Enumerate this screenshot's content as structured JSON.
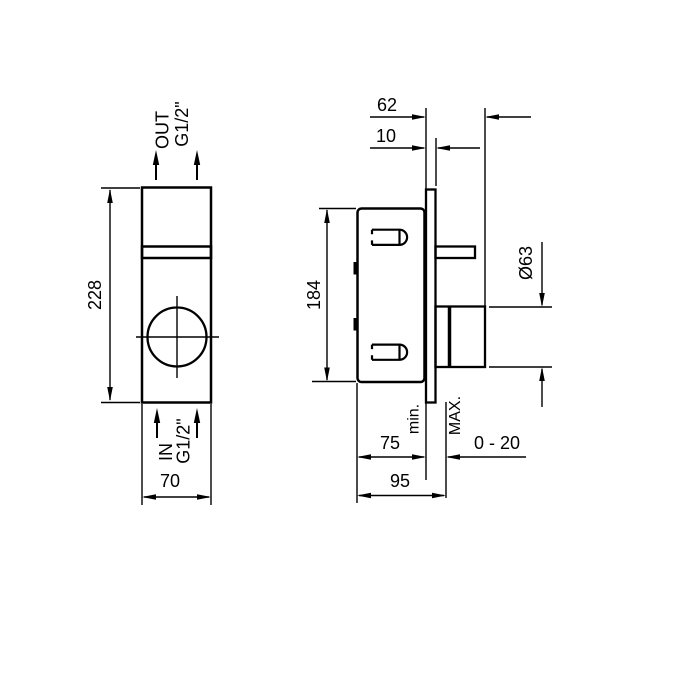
{
  "colors": {
    "line": "#000000",
    "background": "#ffffff"
  },
  "front_view": {
    "height": "228",
    "width": "70",
    "outlet": "OUT",
    "outlet_thread": "G1/2\"",
    "inlet": "IN",
    "inlet_thread": "G1/2\""
  },
  "side_view": {
    "projection_depth": "62",
    "plate_thickness": "10",
    "body_height": "184",
    "handle_diameter": "Ø63",
    "min": "min.",
    "max": "MAX.",
    "depth_min": "75",
    "wall_range": "0 - 20",
    "depth_max": "95"
  }
}
